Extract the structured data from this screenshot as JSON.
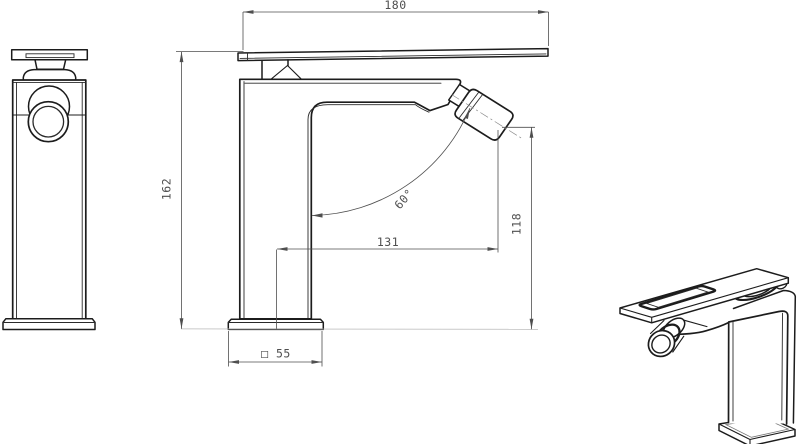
{
  "drawing": {
    "colors": {
      "background": "#ffffff",
      "outline": "#1c1c1c",
      "dimension_lines": "#4f4f4f",
      "reference_line": "#b8b8b8"
    },
    "dimensions": {
      "overall_width": "180",
      "overall_height": "162",
      "spout_reach": "131",
      "spout_outlet_height": "118",
      "spout_angle": "60°",
      "base_square": "□ 55"
    }
  }
}
